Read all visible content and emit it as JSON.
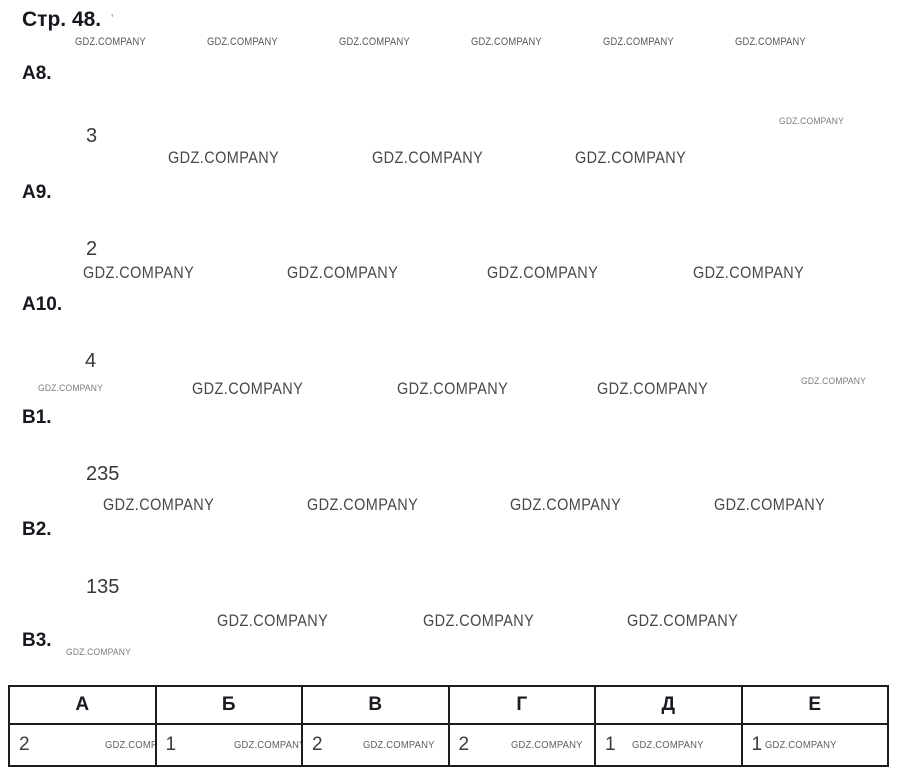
{
  "page_title": "Стр. 48.",
  "title_mark": "'",
  "watermark_text": "GDZ.COMPANY",
  "items": [
    {
      "label": "А8.",
      "answer": "3"
    },
    {
      "label": "А9.",
      "answer": "2"
    },
    {
      "label": "А10.",
      "answer": "4"
    },
    {
      "label": "В1.",
      "answer": "235"
    },
    {
      "label": "В2.",
      "answer": "135"
    },
    {
      "label": "В3.",
      "answer": ""
    }
  ],
  "answer_table": {
    "headers": [
      "А",
      "Б",
      "В",
      "Г",
      "Д",
      "Е"
    ],
    "values": [
      "2",
      "1",
      "2",
      "2",
      "1",
      "1"
    ]
  }
}
